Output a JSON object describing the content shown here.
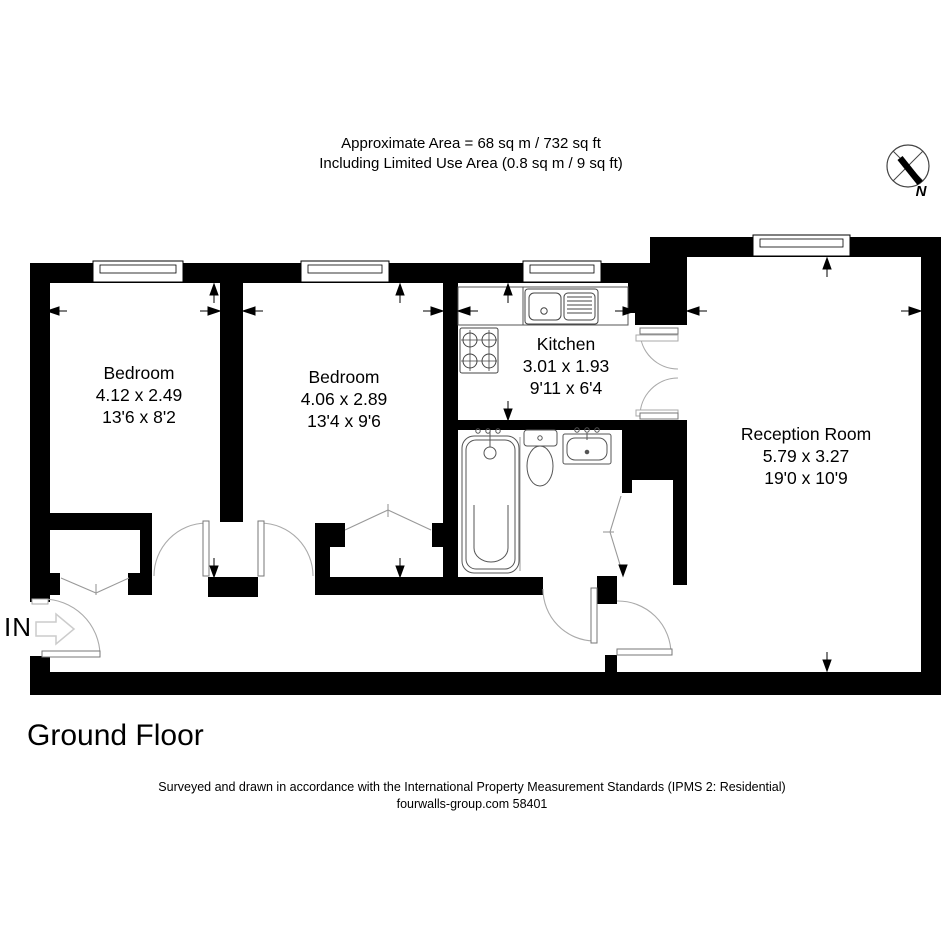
{
  "header": {
    "line1": "Approximate Area = 68 sq m / 732 sq ft",
    "line2": "Including Limited Use Area (0.8 sq m / 9 sq ft)"
  },
  "compass": {
    "north_label": "N"
  },
  "entrance": {
    "label": "IN"
  },
  "rooms": [
    {
      "name": "Bedroom",
      "metric": "4.12 x 2.49",
      "imperial": "13'6 x 8'2"
    },
    {
      "name": "Bedroom",
      "metric": "4.06 x 2.89",
      "imperial": "13'4 x 9'6"
    },
    {
      "name": "Kitchen",
      "metric": "3.01 x 1.93",
      "imperial": "9'11 x 6'4"
    },
    {
      "name": "Reception Room",
      "metric": "5.79 x 3.27",
      "imperial": "19'0 x 10'9"
    }
  ],
  "floor": {
    "title": "Ground Floor"
  },
  "footer": {
    "line1": "Surveyed and drawn in accordance with the International Property Measurement Standards (IPMS 2: Residential)",
    "line2": "fourwalls-group.com 58401"
  },
  "colors": {
    "wall": "#000000",
    "background": "#ffffff",
    "door_arc": "#aaaaaa",
    "entry_arrow": "#cccccc"
  }
}
